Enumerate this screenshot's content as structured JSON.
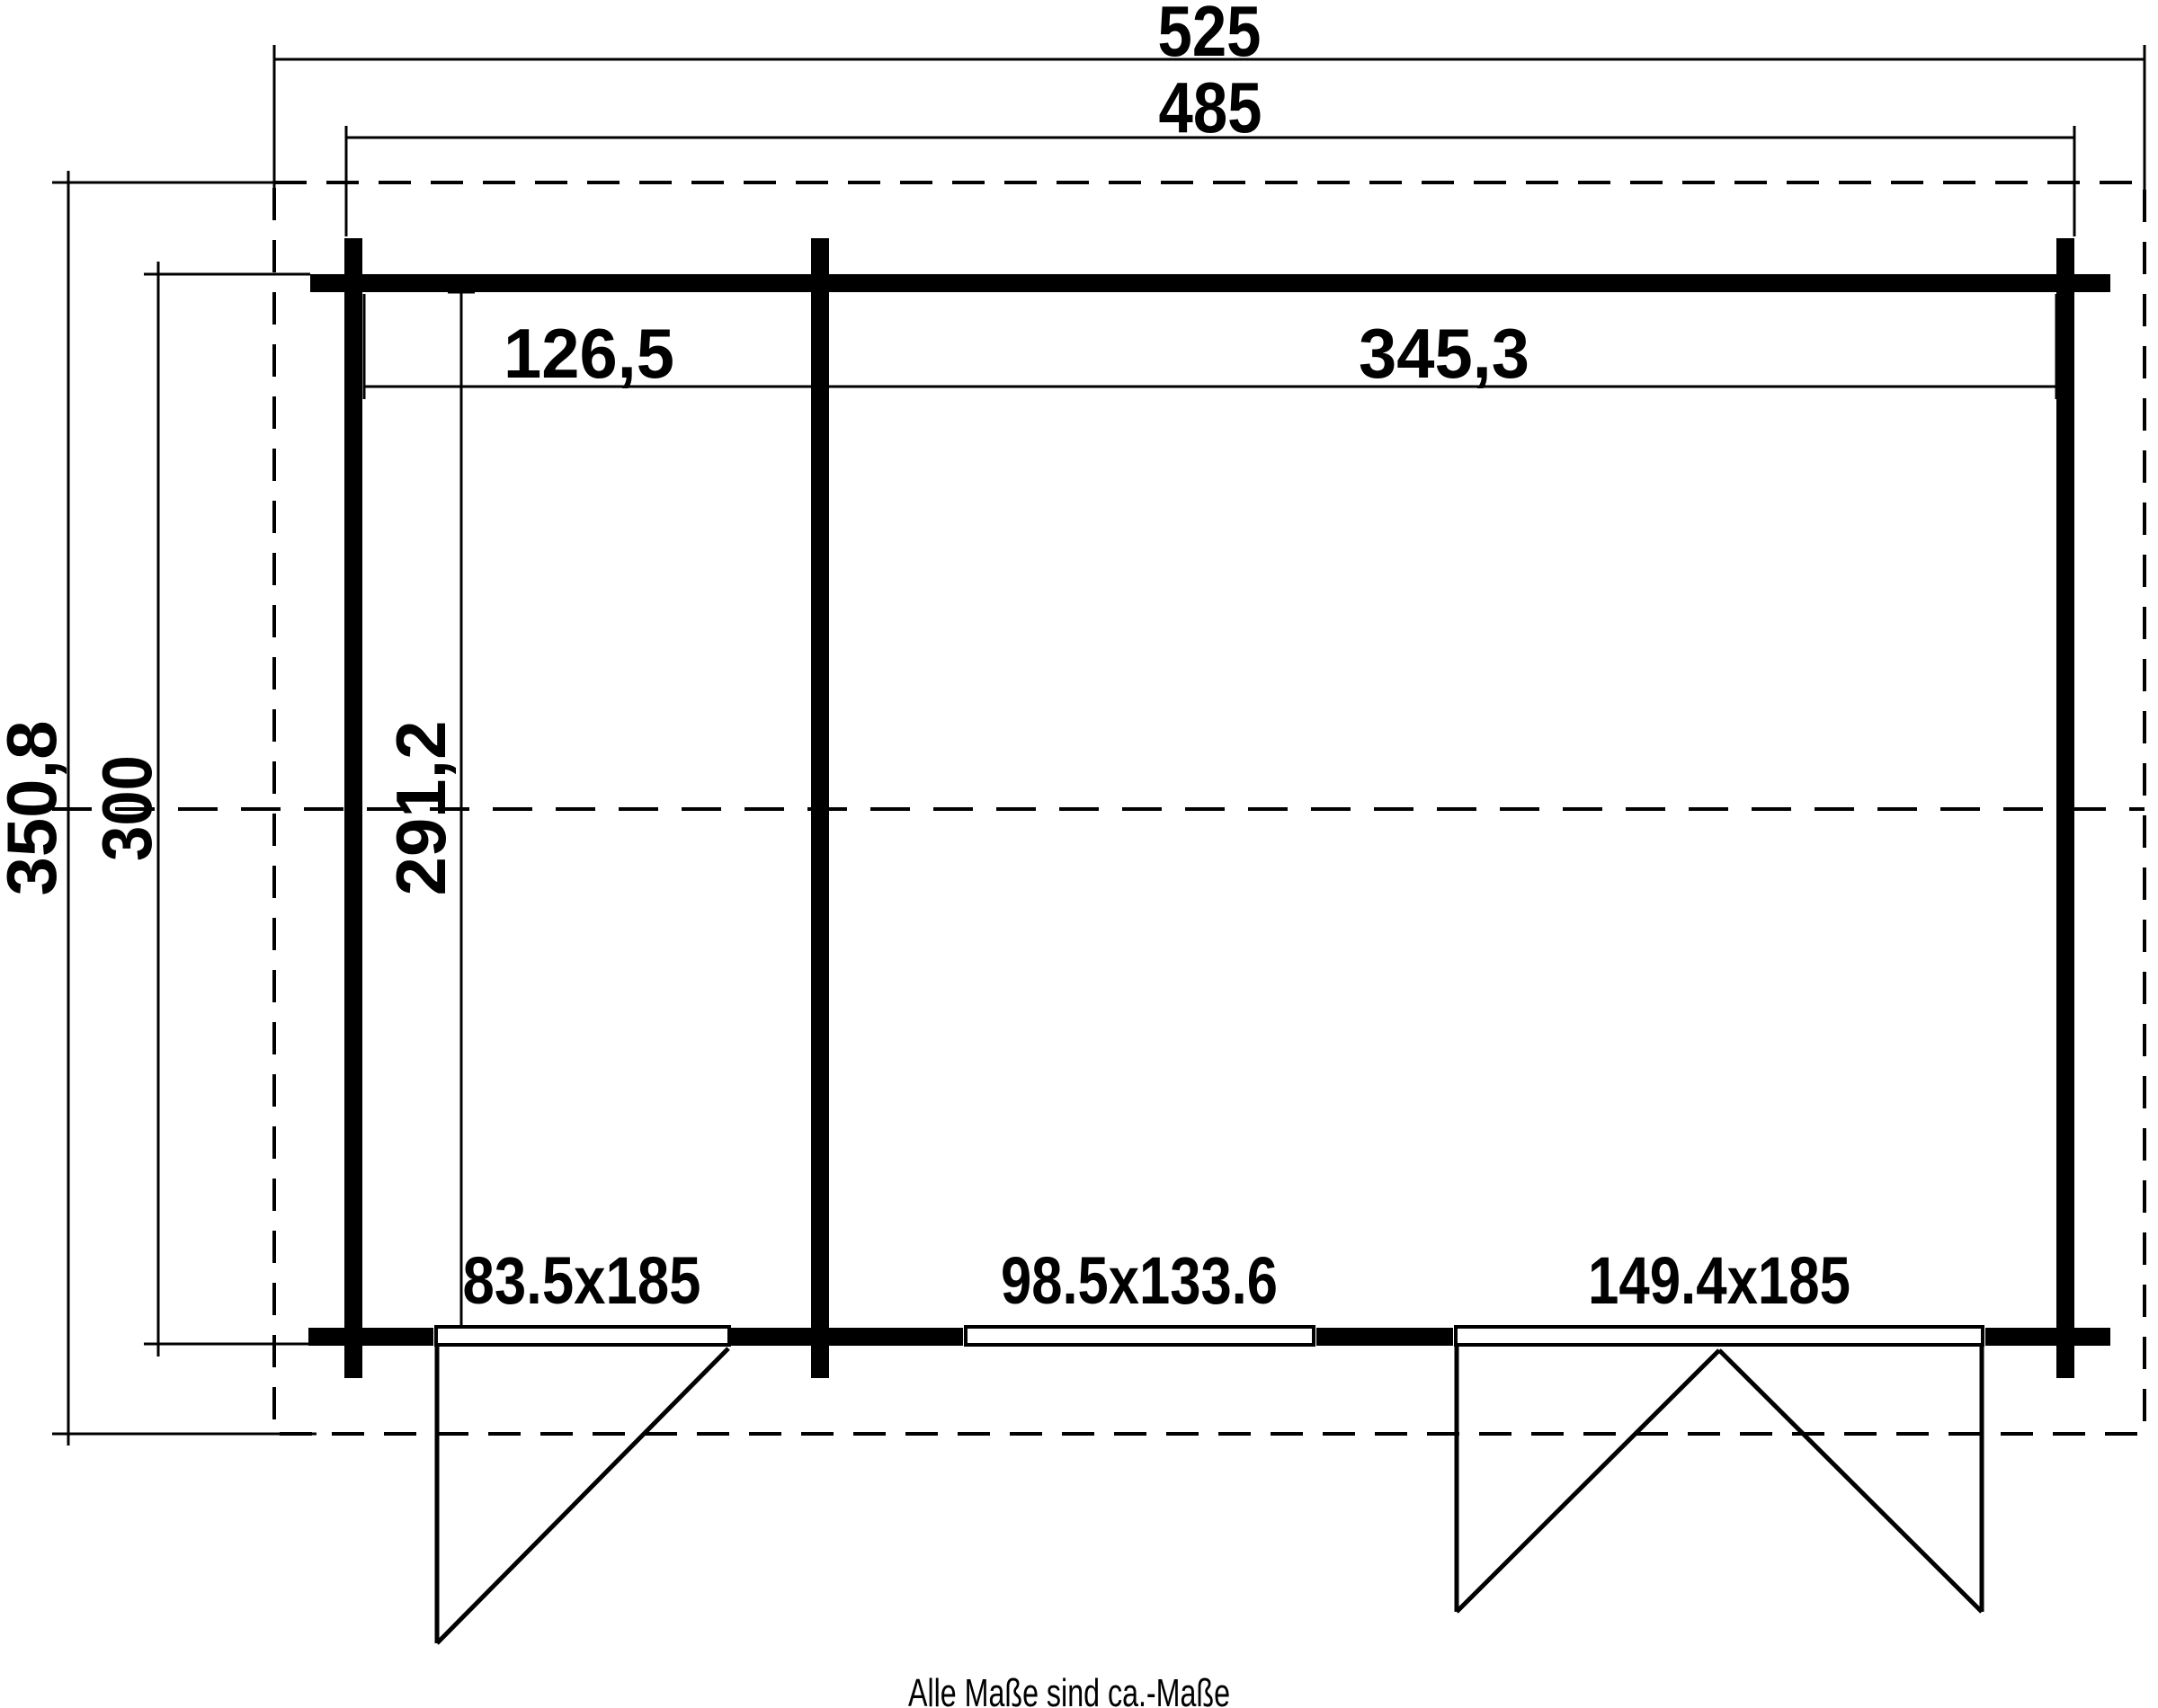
{
  "plan": {
    "title_note": "Alle Maße sind ca.-Maße",
    "dimensions": {
      "overall_width": "525",
      "building_width": "485",
      "overall_depth": "350,8",
      "building_depth": "300",
      "left_room_width": "126,5",
      "right_room_width": "345,3",
      "inner_depth": "291,2"
    },
    "openings": {
      "single_door": "83.5x185",
      "window": "98.5x133.6",
      "double_door": "149.4x185"
    },
    "colors": {
      "line": "#000000",
      "background": "#ffffff"
    }
  }
}
